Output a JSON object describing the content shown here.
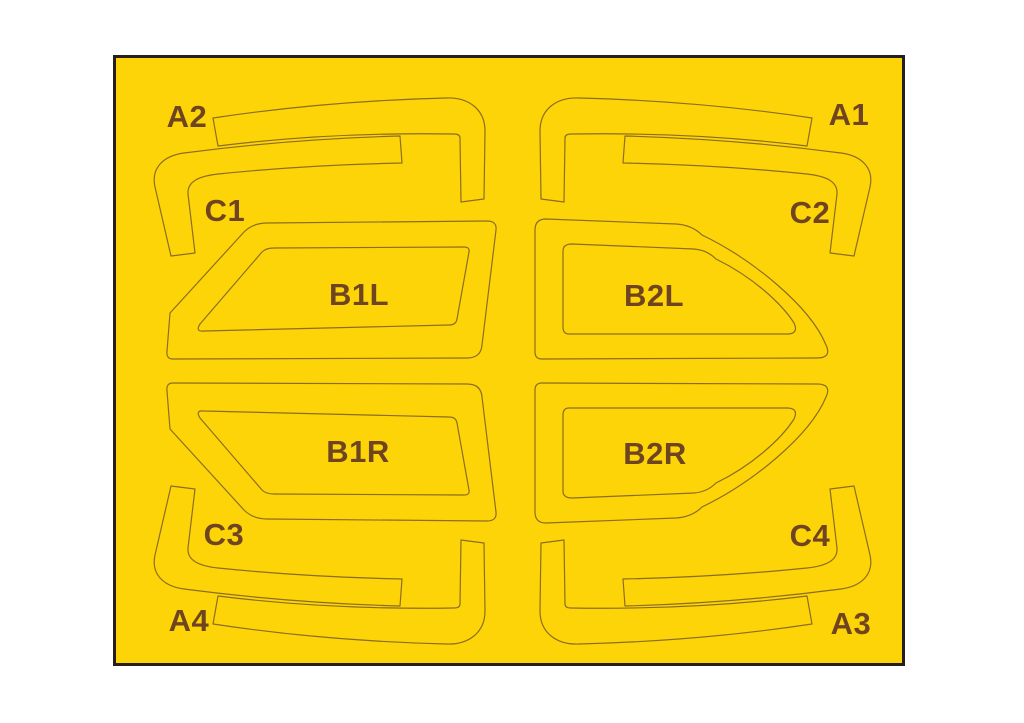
{
  "sheet": {
    "description": "Yellow die-cut masking sheet with twelve labeled mask pieces in four mirrored quadrants",
    "colors": {
      "paper": "#FDD408",
      "cut_line": "#8C6D1F",
      "label_text": "#6E4520",
      "border": "#26201A"
    },
    "labels": {
      "a1": "A1",
      "a2": "A2",
      "a3": "A3",
      "a4": "A4",
      "b1l": "B1L",
      "b1r": "B1R",
      "b2l": "B2L",
      "b2r": "B2R",
      "c1": "C1",
      "c2": "C2",
      "c3": "C3",
      "c4": "C4"
    }
  }
}
